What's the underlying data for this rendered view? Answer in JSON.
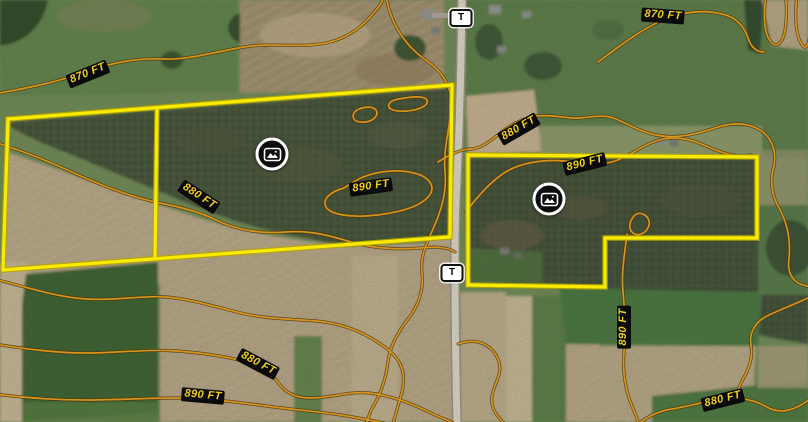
{
  "map": {
    "type": "satellite",
    "elevations_ft": [
      870,
      880,
      890
    ],
    "contour_labels": [
      {
        "text": "870 FT"
      },
      {
        "text": "870 FT"
      },
      {
        "text": "880 FT"
      },
      {
        "text": "890 FT"
      },
      {
        "text": "880 FT"
      },
      {
        "text": "890 FT"
      },
      {
        "text": "880 FT"
      },
      {
        "text": "890 FT"
      },
      {
        "text": "890 FT"
      },
      {
        "text": "880 FT"
      }
    ],
    "route_shields": [
      {
        "label": "T"
      },
      {
        "label": "T"
      }
    ],
    "photo_markers": [
      {
        "icon": "image-icon"
      },
      {
        "icon": "image-icon"
      }
    ],
    "parcel_count": 2,
    "colors": {
      "parcel_boundary": "#f8ea00",
      "contour_line": "#c98812",
      "contour_label_text": "#f2cf1d",
      "contour_label_bg": "#0a0a0a",
      "shield_bg": "#ffffff",
      "shield_border": "#111111",
      "road": "#d7d0c2"
    }
  }
}
